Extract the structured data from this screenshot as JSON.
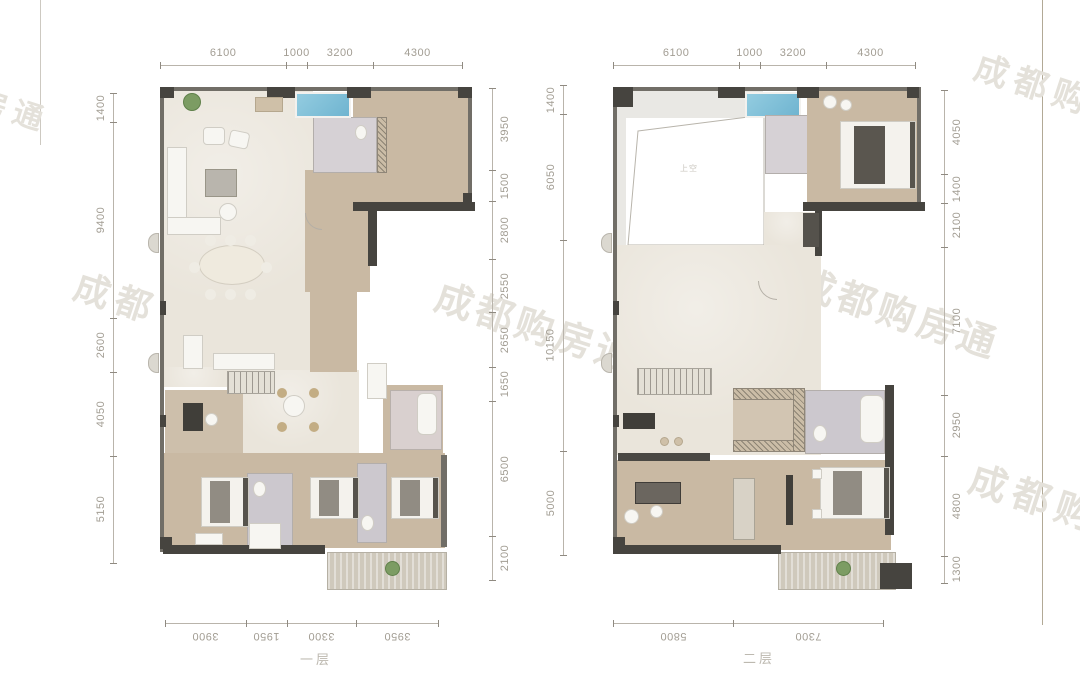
{
  "watermarks": [
    {
      "text": "房通"
    },
    {
      "text": "成都购"
    },
    {
      "text": "成都"
    },
    {
      "text": "成都购房通"
    },
    {
      "text": "成都购房通"
    },
    {
      "text": "成都购房"
    }
  ],
  "floors": [
    {
      "label": "一层",
      "dimensions": {
        "top": [
          6100,
          1000,
          3200,
          4300
        ],
        "left": [
          1400,
          9400,
          2600,
          4050,
          5150
        ],
        "right": [
          3950,
          1500,
          2800,
          2550,
          2650,
          1650,
          6500,
          2100
        ],
        "bottom": [
          3900,
          1950,
          3300,
          3950
        ]
      }
    },
    {
      "label": "二层",
      "void_label": "上空",
      "dimensions": {
        "top": [
          6100,
          1000,
          3200,
          4300
        ],
        "left": [
          1400,
          6050,
          10150,
          5000
        ],
        "right": [
          4050,
          1400,
          2100,
          7100,
          2950,
          4800,
          1300
        ],
        "bottom": [
          5800,
          7300
        ]
      }
    }
  ],
  "colors": {
    "floor_cream": "#eae5db",
    "floor_tan": "#c9b9a3",
    "bath_tile": "#d6d1d5",
    "pool_blue": "#82c0d8",
    "wall_dark": "#46443f",
    "dimension_text": "#a29d93",
    "watermark": "#e4e1da"
  }
}
